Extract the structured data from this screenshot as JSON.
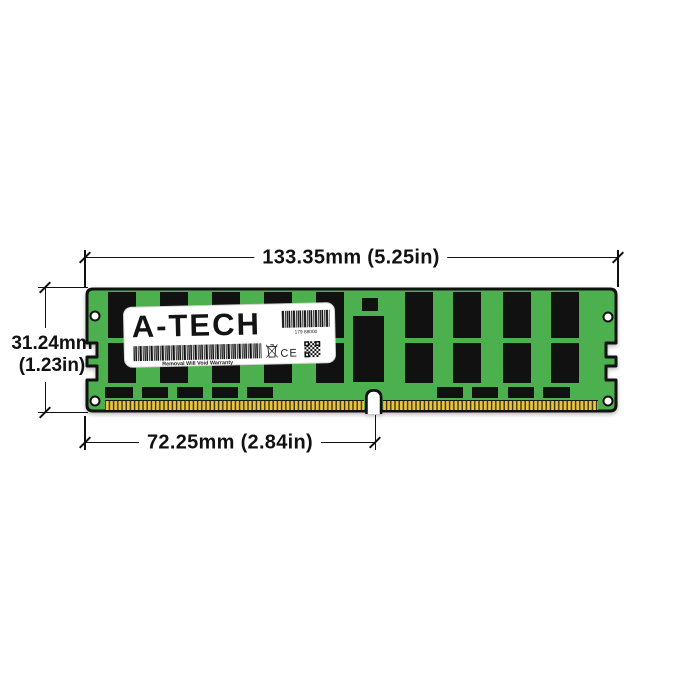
{
  "figure": {
    "dimensions": {
      "width_label": "133.35mm (5.25in)",
      "height_label_line1": "31.24mm",
      "height_label_line2": "(1.23in)",
      "pin_span_label": "72.25mm (2.84in)"
    },
    "module": {
      "brand": "A-TECH",
      "sticker_number": "179 88000",
      "warranty_text": "Removal Will Void Warranty",
      "ce_mark": "CE",
      "colors": {
        "pcb_green": "#4db04e",
        "pin_gold": "#e9c53e",
        "chip_black": "#111111",
        "ink": "#111111",
        "label_white": "#ffffff"
      }
    }
  }
}
